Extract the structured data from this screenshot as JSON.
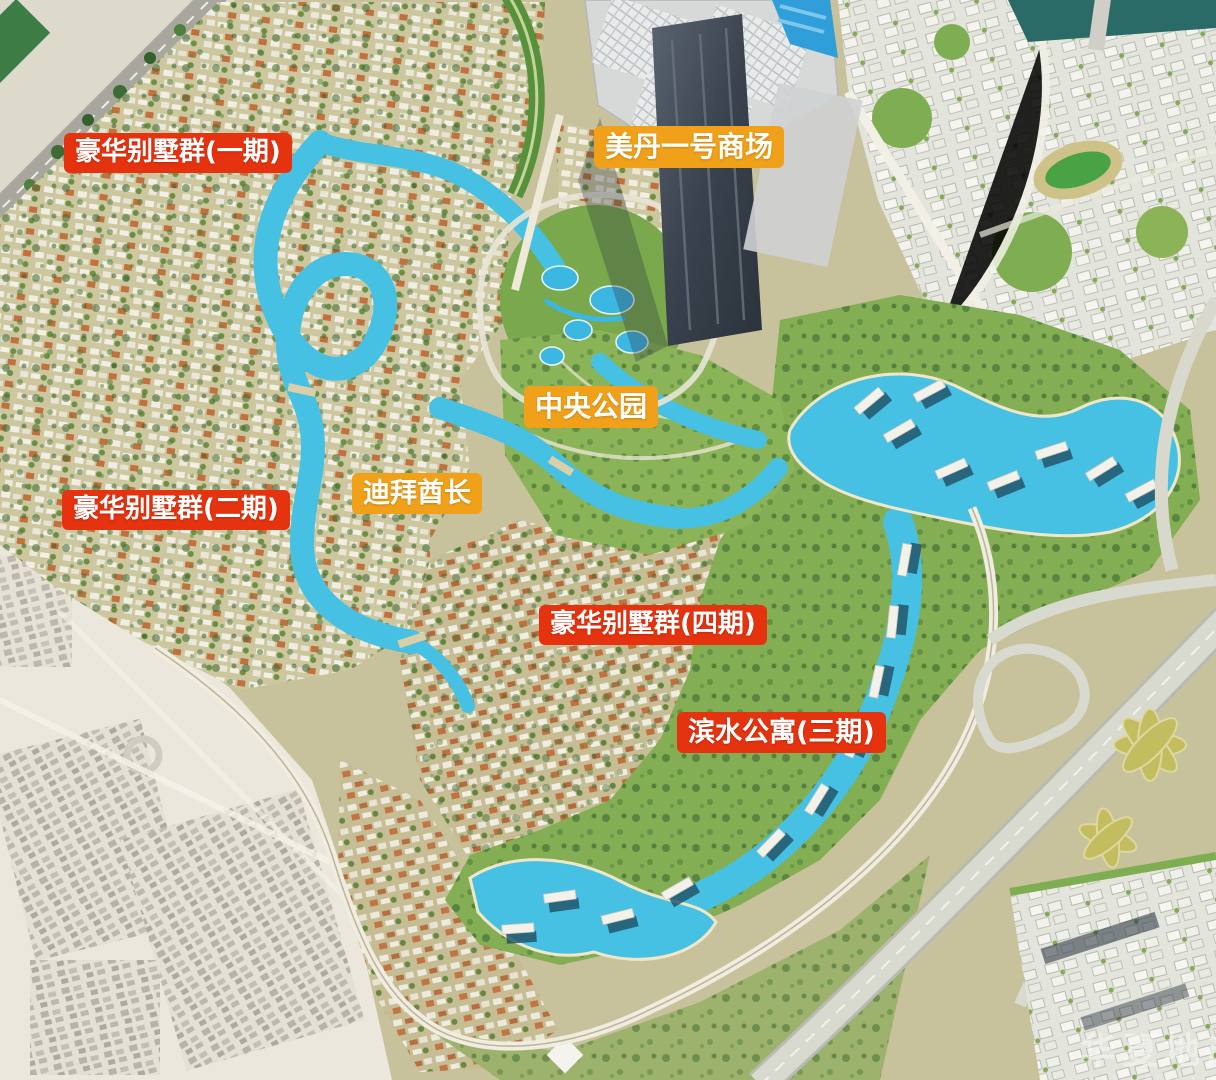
{
  "map": {
    "colors": {
      "badge_red": "#e5330f",
      "badge_orange": "#f0a119",
      "lagoon_turquoise": "#46c1e4",
      "park_green": "#84ae53",
      "desert_sand": "#ebe7dc"
    }
  },
  "labels": [
    {
      "id": "luxury-villas-phase-1",
      "text": "豪华别墅群(一期)",
      "css": "left:64px;top:133px;background:#e5330f;font-size:26px"
    },
    {
      "id": "meydan-one-mall",
      "text": "美丹一号商场",
      "css": "left:594px;top:126px;background:#f0a119;font-size:28px"
    },
    {
      "id": "central-park",
      "text": "中央公园",
      "css": "left:524px;top:386px;background:#f0a119;font-size:28px"
    },
    {
      "id": "dubai-ruler",
      "text": "迪拜酋长",
      "css": "left:352px;top:473px;background:#f0a119;font-size:27px"
    },
    {
      "id": "luxury-villas-phase-2",
      "text": "豪华别墅群(二期)",
      "css": "left:62px;top:490px;background:#e5330f;font-size:26px"
    },
    {
      "id": "luxury-villas-phase-4",
      "text": "豪华别墅群(四期)",
      "css": "left:539px;top:605px;background:#e5330f;font-size:26px"
    },
    {
      "id": "waterfront-apartments-phase-3",
      "text": "滨水公寓(三期)",
      "css": "left:677px;top:712px;background:#e5330f;font-size:27px"
    }
  ],
  "watermark": {
    "text": "华夏地产",
    "subtext": "HUAXIA REAL ESTATE"
  }
}
